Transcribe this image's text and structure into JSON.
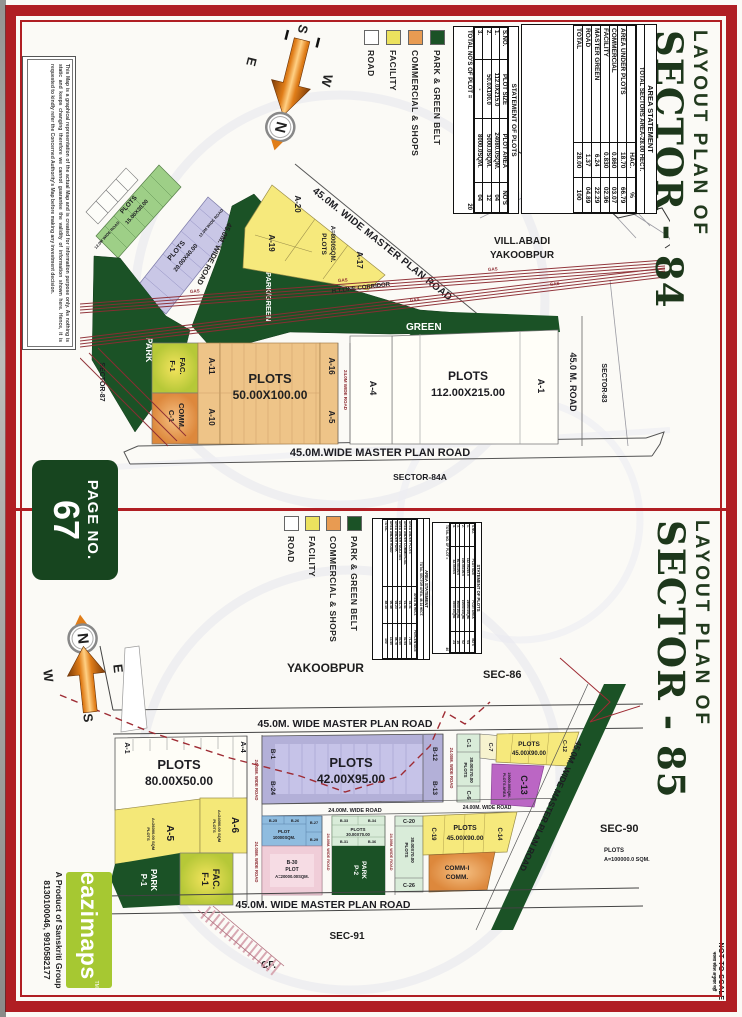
{
  "page": {
    "badge": {
      "label": "PAGE NO.",
      "number": "67"
    },
    "not_to_scale": {
      "line1": "NOT TO SCALE",
      "line2": "नक्शा स्केल अनुसार नहीं"
    },
    "accent_red": "#b01e23"
  },
  "branding": {
    "logo_text": "eazimaps",
    "tm": "TM",
    "tagline": "A Product of Sanskriti Group",
    "phones": "8130100046, 9910582177",
    "logo_color": "#a6c832"
  },
  "disclaimer": "This Map is a graphical representation of the actual Map and is created for information purpose only. As nothing is static and keeps changing therefore we cannot guarantee the validity of information shown here. Hence, it is requested to kindly refer the Concerned Authority's Map before making any investment decision.",
  "compass": {
    "n": "N",
    "s": "S",
    "e": "E",
    "w": "W"
  },
  "legend": {
    "items": [
      {
        "label": "PARK & GREEN BELT",
        "color": "#1b5226"
      },
      {
        "label": "COMMERCIAL & SHOPS",
        "color": "#e89b52"
      },
      {
        "label": "FACILITY",
        "color": "#ece25e"
      },
      {
        "label": "ROAD",
        "color": "#ffffff"
      }
    ]
  },
  "sector84": {
    "title1": "LAYOUT PLAN OF",
    "title2": "SECTOR - 84",
    "area_statement": {
      "title": "AREA STATEMENT",
      "subtitle": "TOTAL SECTORS AREA-28.00 HECT.",
      "col_headers": [
        "",
        "HAC.",
        "%"
      ],
      "rows": [
        [
          "AREA UNDER PLOTS",
          "18.70",
          "66.79"
        ],
        [
          "COMMERCIAL",
          "0.860",
          "03.07"
        ],
        [
          "FACILITY",
          "0.830",
          "02.96"
        ],
        [
          "MASTER GREEN",
          "6.24",
          "22.29"
        ],
        [
          "ROAD",
          "1.37",
          "04.89"
        ],
        [
          "TOTAL",
          "28.00",
          "100"
        ]
      ]
    },
    "plot_statement": {
      "title": "STATEMENT OF PLOTS",
      "col_headers": [
        "S.NO.",
        "PLOT SIZE",
        "PLOT AREA",
        "NO'S"
      ],
      "rows": [
        [
          "1.",
          "112.0X215.0",
          "24080.0SQM.",
          "04"
        ],
        [
          "2.",
          "50.0X100.0",
          "5000.0SQM.",
          "12"
        ],
        [
          "3.",
          "-",
          "8000.0SQM.",
          "04"
        ]
      ],
      "footer_label": "TOTAL NO'S OF PLOT =",
      "footer_value": "20"
    },
    "map": {
      "vill1": "VILL.ABADI",
      "vill2": "YAKOOBPUR",
      "mpr_top": "45.0M. WIDE MASTER PLAN ROAD",
      "mpr_bottom": "45.0M.WIDE MASTER PLAN ROAD",
      "road45": "45.0M. WIDE ROAD",
      "road45_right": "45.0 M. ROAD",
      "road24": "24.0M WIDE ROAD",
      "road12": "12.0M WIDE ROAD",
      "sector83": "SECTOR-83",
      "sector87": "SECTOR-87",
      "sector84a": "SECTOR-84A",
      "green": "GREEN",
      "park": "PARK",
      "park_green": "PARK/GREEN",
      "gas": "GAS",
      "htline": "H.T.LINE CORRIDOR",
      "plots15": [
        "PLOTS",
        "15.00X30.00"
      ],
      "plots20": [
        "PLOTS",
        "20.00X40.00"
      ],
      "plots8000": [
        "PLOTS",
        "A=8000SQM."
      ],
      "plots50": [
        "PLOTS",
        "50.00X100.00"
      ],
      "plots112": [
        "PLOTS",
        "112.00X215.00"
      ],
      "a20": "A-20",
      "a19": "A-19",
      "a17": "A-17",
      "a16": "A-16",
      "a5": "A-5",
      "a11": "A-11",
      "a10": "A-10",
      "a4": "A-4",
      "a1": "A-1",
      "f1": [
        "F-1",
        "FAC."
      ],
      "c1": [
        "C-1",
        "COMM."
      ]
    }
  },
  "sector85": {
    "title1": "LAYOUT PLAN OF",
    "title2": "SECTOR - 85",
    "area_statement": {
      "title": "AREA STATEMENT",
      "subtitle": "TOTAL SECTOR AREA- 48.14 HECT.",
      "col_headers": [
        "",
        "AREA IN HECT.",
        "PERCENTAGE"
      ],
      "rows": [
        [
          "AREA UNDER PLOTS",
          "34.31",
          "71.28"
        ],
        [
          "AREA UNDER COMMERCIAL",
          "01.41",
          "02.94"
        ],
        [
          "AREA UNDER FACILITIES",
          "01.71",
          "03.55"
        ],
        [
          "AREA UNDER PARK",
          "04.23",
          "08.78"
        ],
        [
          "AREA UNDER ROAD",
          "06.48",
          "13.45"
        ],
        [
          "TOTAL",
          "48.14",
          "100"
        ]
      ]
    },
    "plot_statement": {
      "title": "STATEMENT OF PLOTS",
      "col_headers": [
        "S.NO.",
        "PLOT SIZE",
        "PLOT AREA",
        "NO'S"
      ],
      "rows": [
        [
          "1.",
          "112.0X215.0",
          "24080.0SQM.",
          "04"
        ],
        [
          "2.",
          "100.0X100.0",
          "10000.0SQM.",
          "02"
        ],
        [
          "3.",
          "80.0X100.0",
          "8000.0SQM.",
          "10"
        ],
        [
          "4.",
          "42.0X95.0",
          "3990.0SQM.",
          "24"
        ]
      ],
      "footer_label": "TOTAL NO. OF PLOT =",
      "footer_value": "40"
    },
    "map": {
      "yakoobpur": "YAKOOBPUR",
      "sec86": "SEC-86",
      "sec90": "SEC-90",
      "sec91": "SEC-91",
      "cf": "CF.",
      "mpr": "45.0M. WIDE MASTER PLAN ROAD",
      "road24v": "24.00M. WIDE ROAD",
      "road24h": "24.00M. WIDE ROAD",
      "plots80": [
        "PLOTS",
        "80.00X50.00"
      ],
      "plots42": [
        "PLOTS",
        "42.00X95.00"
      ],
      "plots45": [
        "PLOTS",
        "45.00X90.00"
      ],
      "plots30": [
        "PLOTS",
        "30.00X70.00"
      ],
      "plot10000": [
        "PLOT",
        "10000SQM."
      ],
      "b30": [
        "B-30",
        "PLOT",
        "A=20000.00SQM."
      ],
      "c13sub": [
        "PLOTS AREA",
        "19000.00SQM."
      ],
      "plots100k": [
        "PLOTS",
        "A=100000.0 SQM."
      ],
      "a5sub": [
        "PLOTS",
        "A=26000.00 SQM"
      ],
      "a6sub": [
        "PLOTS",
        "A=24000.00 SQM"
      ],
      "a1": "A-1",
      "a4": "A-4",
      "a5": "A-5",
      "a6": "A-6",
      "p1": [
        "P-1",
        "PARK"
      ],
      "p2": [
        "P-2",
        "PARK"
      ],
      "f1": [
        "F-1",
        "FAC."
      ],
      "b1": "B-1",
      "b24": "B-24",
      "b12": "B-12",
      "b13": "B-13",
      "b25": "B-25",
      "b26": "B-26",
      "b27": "B-27",
      "b29": "B-29",
      "b33": "B-33",
      "b34": "B-34",
      "b31": "B-31",
      "b36": "B-36",
      "c1": "C-1",
      "c6": "C-6",
      "c7": "C-7",
      "c12": "C-12",
      "c13": "C-13",
      "c14": "C-14",
      "c19": "C-19",
      "c20": "C-20",
      "c26": "C-26",
      "comm1": [
        "COMM-I",
        "COMM."
      ]
    }
  }
}
